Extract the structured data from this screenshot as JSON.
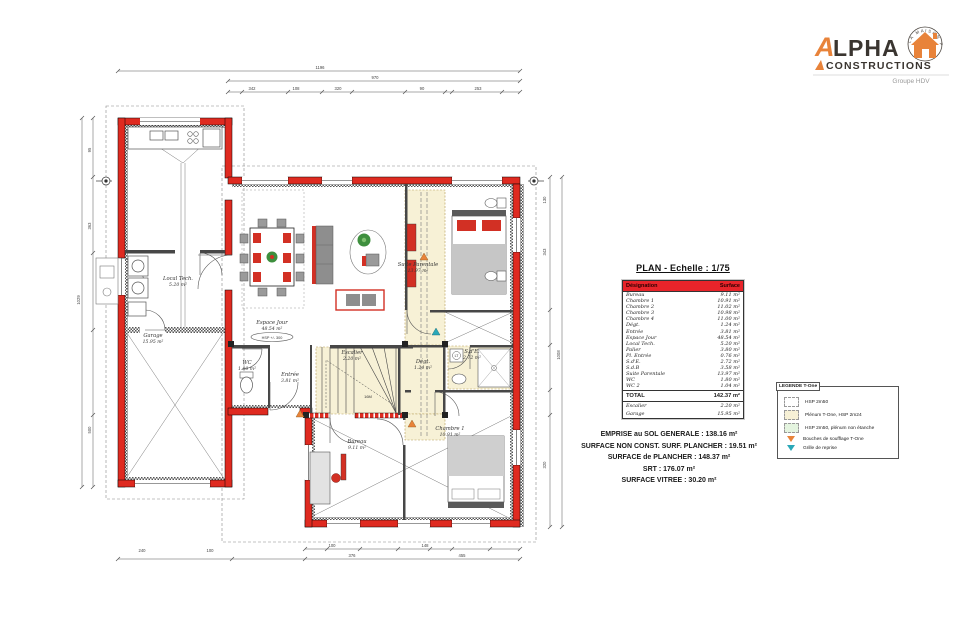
{
  "logo": {
    "brand_a": "A",
    "brand_rest": "LPHA",
    "line2": "CONSTRUCTIONS",
    "subtitle": "Groupe HDV",
    "stamp_text": "LA MAISON PARFAITE",
    "colors": {
      "accent": "#E8833A",
      "dark": "#3A3530"
    }
  },
  "plan_title": "PLAN - Echelle : 1/75",
  "surface_table": {
    "headers": [
      "Désignation",
      "Surface"
    ],
    "rows": [
      [
        "Bureau",
        "9.11 m²"
      ],
      [
        "Chambre 1",
        "10.91 m²"
      ],
      [
        "Chambre 2",
        "11.02 m²"
      ],
      [
        "Chambre 3",
        "10.98 m²"
      ],
      [
        "Chambre 4",
        "11.00 m²"
      ],
      [
        "Dégt.",
        "1.24 m²"
      ],
      [
        "Entrée",
        "3.81 m²"
      ],
      [
        "Espace Jour",
        "48.54 m²"
      ],
      [
        "Local Tech.",
        "5.20 m²"
      ],
      [
        "Palier",
        "3.80 m²"
      ],
      [
        "Pl. Entrée",
        "0.76 m²"
      ],
      [
        "S.d'E.",
        "2.72 m²"
      ],
      [
        "S.d.B",
        "3.58 m²"
      ],
      [
        "Suite Parentale",
        "13.97 m²"
      ],
      [
        "WC",
        "1.80 m²"
      ],
      [
        "WC 2",
        "1.04 m²"
      ]
    ],
    "total_row": [
      "TOTAL",
      "142.37 m²"
    ],
    "annex_rows": [
      [
        "Escalier",
        "2.20 m²"
      ],
      [
        "Garage",
        "15.95 m²"
      ]
    ]
  },
  "summary_lines": [
    "EMPRISE au SOL GENERALE : 138.16 m²",
    "SURFACE NON CONST. SURF. PLANCHER : 19.51 m²",
    "SURFACE de PLANCHER : 148.37 m²",
    "SRT : 176.07 m²",
    "SURFACE VITREE : 30.20 m²"
  ],
  "legend": {
    "title": "LEGENDE T-One",
    "items": [
      {
        "icon": "swatch-white",
        "label": "HSP 2m50"
      },
      {
        "icon": "swatch-cream",
        "label": "Plénum T-One, HSP 2m24"
      },
      {
        "icon": "swatch-green",
        "label": "HSP 2m50, plénum non étanche"
      },
      {
        "icon": "triangle-orange",
        "label": "Bouches de soufflage T-One"
      },
      {
        "icon": "triangle-teal",
        "label": "Grille de reprise"
      }
    ]
  },
  "plan": {
    "rooms": [
      {
        "name": "Espace Jour",
        "area": "48.54 m²",
        "x": 272,
        "y": 324
      },
      {
        "name": "Local Tech.",
        "area": "5.20 m²",
        "x": 178,
        "y": 280
      },
      {
        "name": "Garage",
        "area": "15.95 m²",
        "x": 153,
        "y": 337
      },
      {
        "name": "WC",
        "area": "1.80 m²",
        "x": 247,
        "y": 364
      },
      {
        "name": "Entrée",
        "area": "3.81 m²",
        "x": 290,
        "y": 376
      },
      {
        "name": "Escalier",
        "area": "2.20 m²",
        "x": 352,
        "y": 354
      },
      {
        "name": "Bureau",
        "area": "9.11 m²",
        "x": 357,
        "y": 443
      },
      {
        "name": "Chambre 1",
        "area": "10.91 m²",
        "x": 450,
        "y": 430
      },
      {
        "name": "Suite Parentale",
        "area": "13.97 m²",
        "x": 418,
        "y": 266
      },
      {
        "name": "S.d'E.",
        "area": "2.72 m²",
        "x": 472,
        "y": 353
      },
      {
        "name": "Dégt.",
        "area": "1.24 m²",
        "x": 423,
        "y": 363
      }
    ],
    "annotations": {
      "hsp_badge": "HSP +/- 300",
      "stair_note": "16M",
      "washer": "LT"
    },
    "dim_labels": [
      {
        "v": "1196",
        "x": 320,
        "y": 69,
        "r": 0
      },
      {
        "v": "970",
        "x": 375,
        "y": 79,
        "r": 0
      },
      {
        "v": "342",
        "x": 252,
        "y": 90,
        "r": 0
      },
      {
        "v": "108",
        "x": 296,
        "y": 90,
        "r": 0
      },
      {
        "v": "320",
        "x": 338,
        "y": 90,
        "r": 0
      },
      {
        "v": "90",
        "x": 422,
        "y": 90,
        "r": 0
      },
      {
        "v": "253",
        "x": 478,
        "y": 90,
        "r": 0
      },
      {
        "v": "1029",
        "x": 80,
        "y": 300,
        "r": -90
      },
      {
        "v": "95",
        "x": 91,
        "y": 150,
        "r": -90
      },
      {
        "v": "363",
        "x": 91,
        "y": 226,
        "r": -90
      },
      {
        "v": "500",
        "x": 91,
        "y": 430,
        "r": -90
      },
      {
        "v": "1008",
        "x": 560,
        "y": 355,
        "r": -90
      },
      {
        "v": "130",
        "x": 546,
        "y": 200,
        "r": -90
      },
      {
        "v": "343",
        "x": 546,
        "y": 252,
        "r": -90
      },
      {
        "v": "320",
        "x": 546,
        "y": 465,
        "r": -90
      },
      {
        "v": "240",
        "x": 142,
        "y": 552,
        "r": 0
      },
      {
        "v": "100",
        "x": 210,
        "y": 552,
        "r": 0
      },
      {
        "v": "100",
        "x": 332,
        "y": 547,
        "r": 0
      },
      {
        "v": "148",
        "x": 425,
        "y": 547,
        "r": 0
      },
      {
        "v": "376",
        "x": 352,
        "y": 557,
        "r": 0
      },
      {
        "v": "455",
        "x": 462,
        "y": 557,
        "r": 0
      }
    ],
    "colors": {
      "wall_red": "#DF2A20",
      "plenum_cream": "#F7F1D6",
      "accent_orange": "#E8833A",
      "teal": "#2AA8B8"
    }
  }
}
